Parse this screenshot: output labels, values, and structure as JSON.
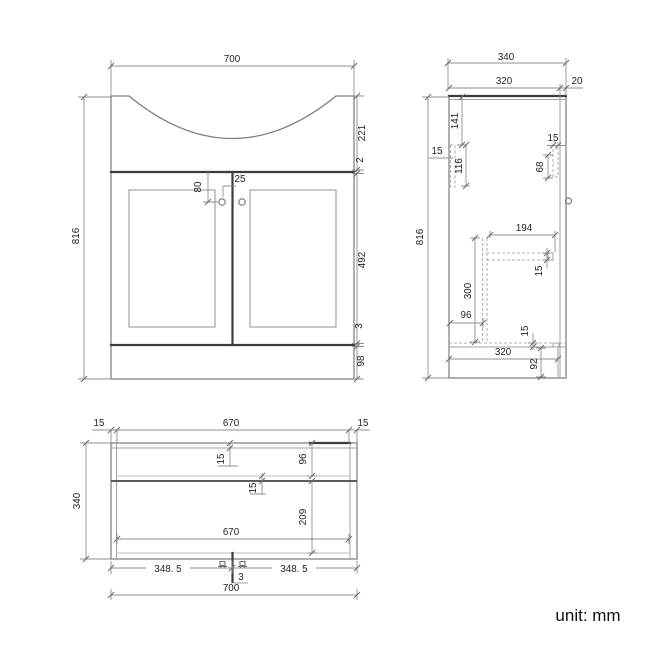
{
  "note": {
    "unit": "unit: mm"
  },
  "front_view": {
    "total_width": "700",
    "total_height": "816",
    "top_section_height": "221",
    "counter_gap": "2",
    "door_height": "492",
    "door_bottom_gap": "3",
    "plinth_height": "98",
    "handle_drop": "80",
    "handle_offset": "25"
  },
  "side_view": {
    "total_depth": "340",
    "carcass_depth": "320",
    "door_thickness": "20",
    "total_height": "816",
    "top_batten_drop": "141",
    "front_batten_thickness": "15",
    "front_batten_length": "116",
    "rear_batten_thickness": "15",
    "rear_batten_length": "68",
    "shelf_depth": "194",
    "shelf_thickness": "15",
    "partition_height": "300",
    "partition_inset": "96",
    "bottom_thickness": "15",
    "bottom_depth": "320",
    "plinth_height": "92"
  },
  "plan_view": {
    "left_side_thickness": "15",
    "inner_width_top": "670",
    "right_side_thickness": "15",
    "total_depth": "340",
    "back_panel_thickness": "15",
    "back_rail_inset": "96",
    "rail_thickness": "15",
    "front_section_depth": "209",
    "inner_width": "670",
    "left_door_width": "348. 5",
    "right_door_width": "348. 5",
    "door_gap": "3",
    "total_width": "700"
  }
}
